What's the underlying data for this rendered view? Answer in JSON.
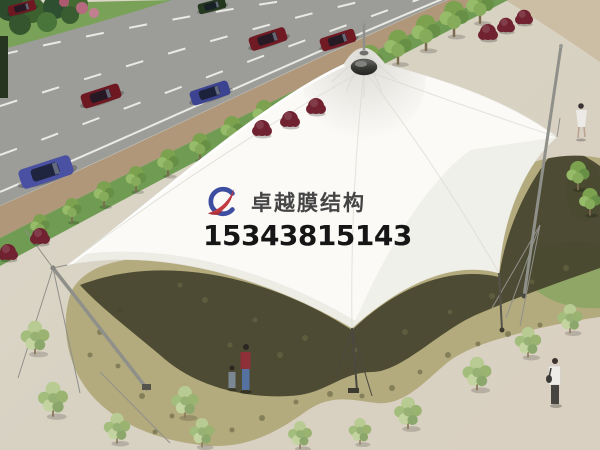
{
  "meta": {
    "type": "architectural-rendering",
    "subject": "Aerial rendering of a white tensile membrane canopy over a stone-paved plaza beside a road"
  },
  "watermark": {
    "company_name": "卓越膜结构",
    "phone_number": "15343815143",
    "logo": "zy-swoosh-monogram",
    "logo_blue": "#3d4da0",
    "logo_red": "#c13a42",
    "company_color": "#454545",
    "phone_color": "#161616"
  },
  "scene": {
    "road": {
      "description": "diagonal asphalt road with dashed lane markings",
      "cars": [
        {
          "id": "car-1",
          "color": "#6e1822"
        },
        {
          "id": "car-2",
          "color": "#24381f"
        },
        {
          "id": "car-3",
          "color": "#6e1822"
        },
        {
          "id": "car-4",
          "color": "#3c4390"
        },
        {
          "id": "car-5",
          "color": "#701a24"
        },
        {
          "id": "car-6",
          "color": "#701a24"
        },
        {
          "id": "car-7",
          "color": "#4a51a3"
        }
      ]
    },
    "membrane": {
      "description": "white tensile fabric canopy with central cone, peak cap and spire, guyed masts and cables"
    },
    "grounds": {
      "plaza": "beige paved plaza",
      "stone_area": "khaki flagstone paving with cast canopy shadow",
      "vegetation": "street trees on grass verge, red shrubs, scattered young trees",
      "people_count": 4
    }
  },
  "palette": {
    "plaza": "#d8d2c3",
    "road": "#9c9c98",
    "lane_marking": "#e9e9e5",
    "sidewalk": "#b0977a",
    "grass_verge": "#6f9b52",
    "foliage_dark": "#2d4a2b",
    "shrub_red": "#702230",
    "stone_paving": "#b3ab7d",
    "canopy_shadow": "#44422d",
    "membrane_white": "#fbfaf7",
    "mast_gray": "#90908a",
    "tree_light_green": "#a9c07f"
  }
}
